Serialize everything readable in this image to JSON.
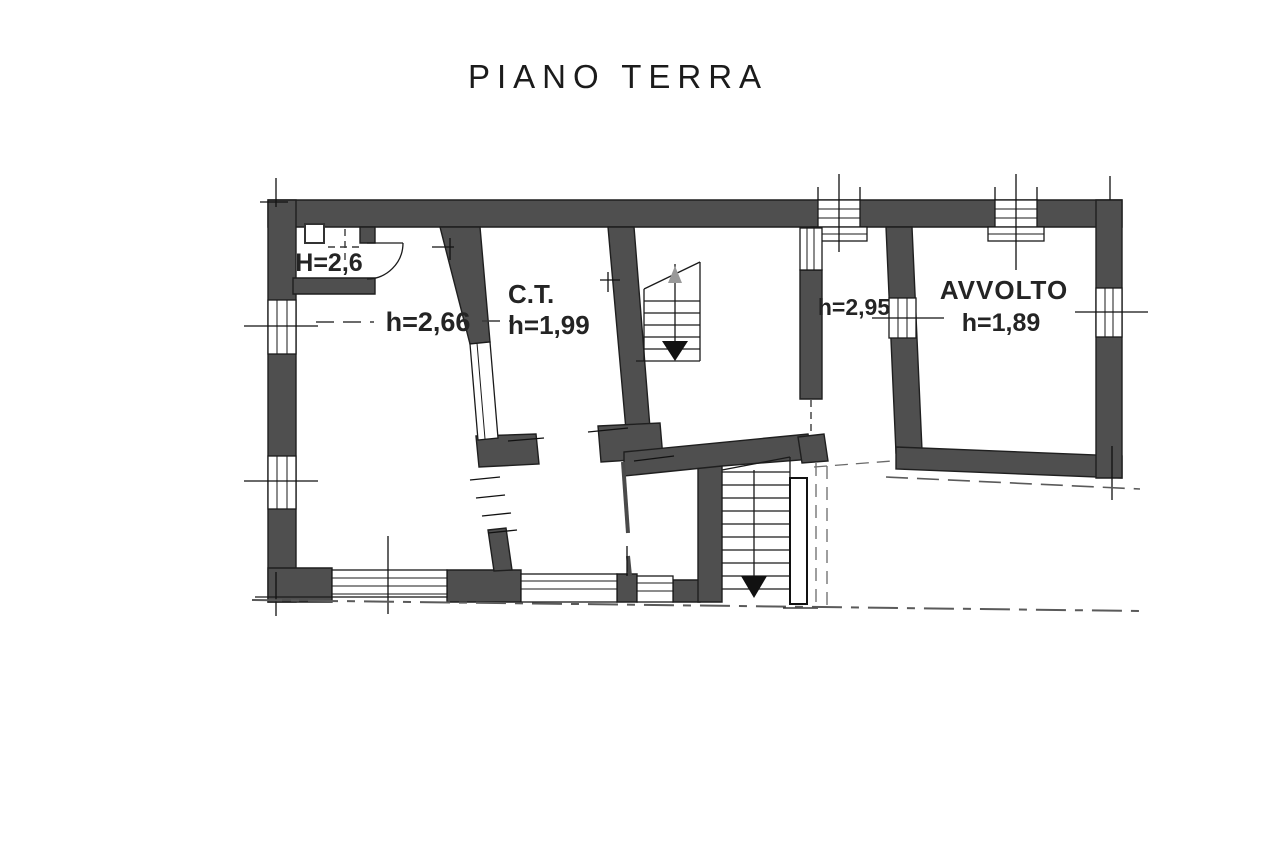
{
  "title": "PIANO TERRA",
  "rooms": {
    "storage": {
      "label": "H=2,6"
    },
    "main_room": {
      "label": "h=2,66"
    },
    "boiler_room": {
      "name": "C.T.",
      "label": "h=1,99"
    },
    "corridor": {
      "label": "h=2,95"
    },
    "cellar": {
      "name": "AVVOLTO",
      "label": "h=1,89"
    }
  },
  "stairs": {
    "upper_direction": "down",
    "lower_direction": "down"
  },
  "colors": {
    "wall": "#4f4f4f",
    "line": "#1a1a1a",
    "text": "#242424",
    "background": "#ffffff"
  }
}
